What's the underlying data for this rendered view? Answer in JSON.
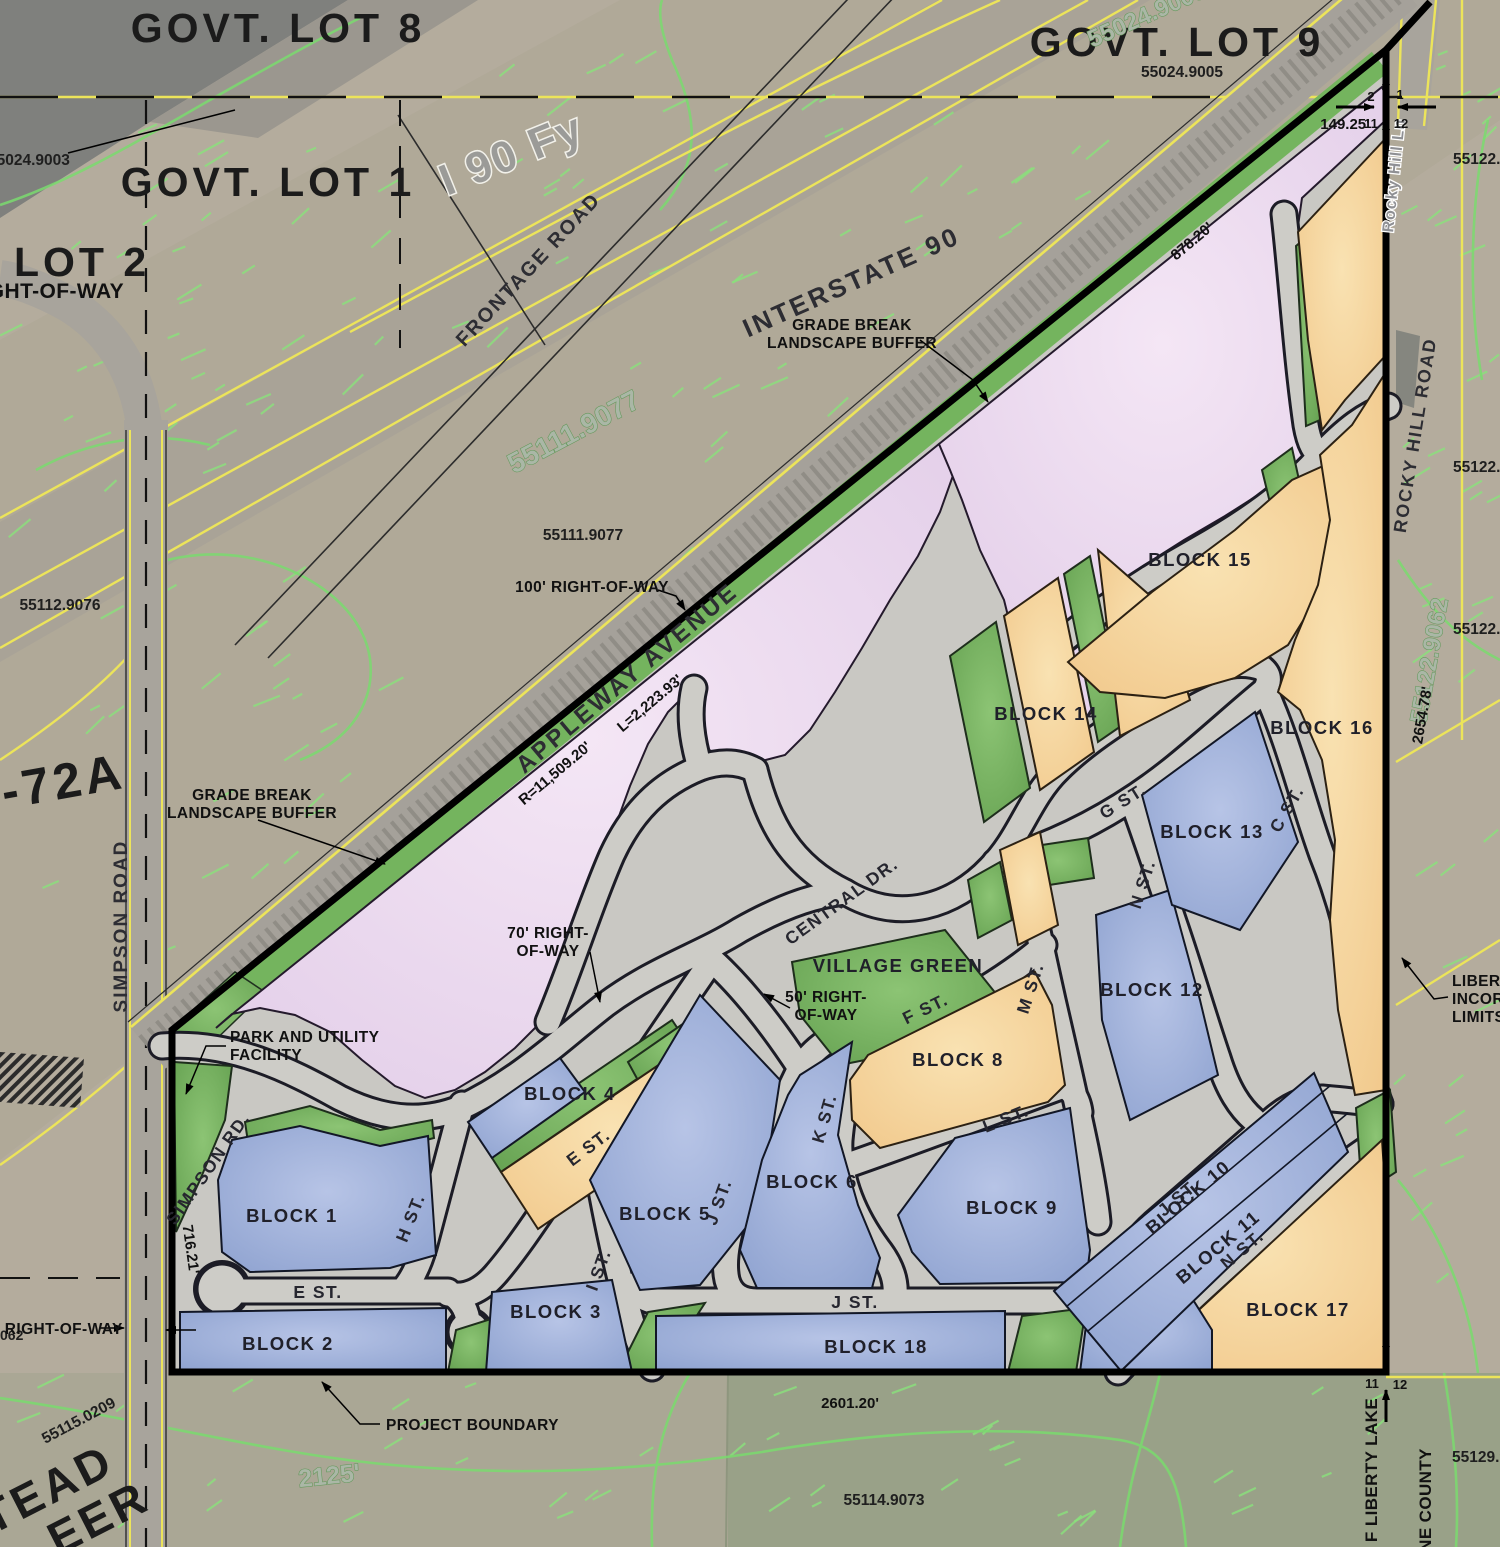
{
  "map": {
    "lots": {
      "lot8": "GOVT. LOT 8",
      "lot9": "GOVT. LOT 9",
      "lot1": "GOVT. LOT 1",
      "lot2": "LOT 2",
      "lot2row": "RIGHT-OF-WAY",
      "lot72a": "90-72A"
    },
    "parcels": {
      "p9003": "55024.9003",
      "p9005": "55024.9005",
      "p9005top": "55024.9005",
      "p9077big": "55111.9077",
      "p9077": "55111.9077",
      "p9076": "55112.9076",
      "p9062": "55122.9062",
      "p0209": "55115.0209",
      "p9073": "55114.9073",
      "p90a": "55122.90",
      "p90b": "55122.90",
      "p90c": "55122.90",
      "p9129": "55129.90",
      "p062": "062",
      "contour2125": "2125'"
    },
    "roads": {
      "i90fy": "I 90 Fy",
      "interstate90": "INTERSTATE 90",
      "frontage": "FRONTAGE ROAD",
      "appleway": "APPLEWAY AVENUE",
      "simpsonRoad": "SIMPSON ROAD",
      "simpsonRd": "SIMPSON RD.",
      "rockyHillRoad": "ROCKY HILL ROAD",
      "rockyHillLn": "Rocky Hill Ln",
      "central": "CENTRAL DR."
    },
    "streets": {
      "c": "C ST.",
      "e": "E ST.",
      "f": "F ST.",
      "g": "G ST.",
      "h": "H ST.",
      "i": "I ST.",
      "j": "J ST.",
      "k": "K ST.",
      "l": "L ST.",
      "m": "M ST.",
      "n": "N ST."
    },
    "blocks": {
      "b1": "BLOCK 1",
      "b2": "BLOCK 2",
      "b3": "BLOCK 3",
      "b4": "BLOCK 4",
      "b5": "BLOCK 5",
      "b6": "BLOCK 6",
      "b8": "BLOCK 8",
      "b9": "BLOCK 9",
      "b10": "BLOCK 10",
      "b11": "BLOCK 11",
      "b12": "BLOCK 12",
      "b13": "BLOCK 13",
      "b14": "BLOCK 14",
      "b15": "BLOCK 15",
      "b16": "BLOCK 16",
      "b17": "BLOCK 17",
      "b18": "BLOCK 18",
      "villageGreen": "VILLAGE GREEN"
    },
    "dims": {
      "d149": "149.25'",
      "d878": "878.20'",
      "d2654": "2654.78'",
      "d2601": "2601.20'",
      "d716": "716.21'",
      "radius": "R=11,509.20'",
      "arc": "L=2,223.93'"
    },
    "ann": {
      "gb1": "GRADE BREAK",
      "gb2": "LANDSCAPE BUFFER",
      "row100": "100' RIGHT-OF-WAY",
      "row70a": "70' RIGHT-",
      "row70b": "OF-WAY",
      "row50a": "50' RIGHT-",
      "row50b": "OF-WAY",
      "park1": "PARK AND UTILITY",
      "park2": "FACILITY",
      "projBoundary": "PROJECT BOUNDARY",
      "rowPartial": "' RIGHT-OF-WAY",
      "lib1": "LIBERTY",
      "lib2": "INCORPO",
      "lib3": "LIMITS",
      "cityLL": "F LIBERTY LAKE",
      "county": "NE COUNTY",
      "hs1": "TEAD",
      "hs2": "EER"
    },
    "corners": {
      "t2": "2",
      "t1": "1",
      "t11": "11",
      "t12": "12",
      "b11": "11",
      "b12": "12"
    },
    "colors": {
      "residential_blue": "#9db0da",
      "commercial_orange": "#f5cf96",
      "mixed_use_pink": "#e8d4ec",
      "open_space_green": "#76b35f",
      "road_gray": "#cdccc7",
      "boundary_black": "#000000",
      "contour_green": "#7adb6e",
      "section_line_yellow": "#ece45a",
      "aerial_tan": "#b4ac9d"
    }
  }
}
